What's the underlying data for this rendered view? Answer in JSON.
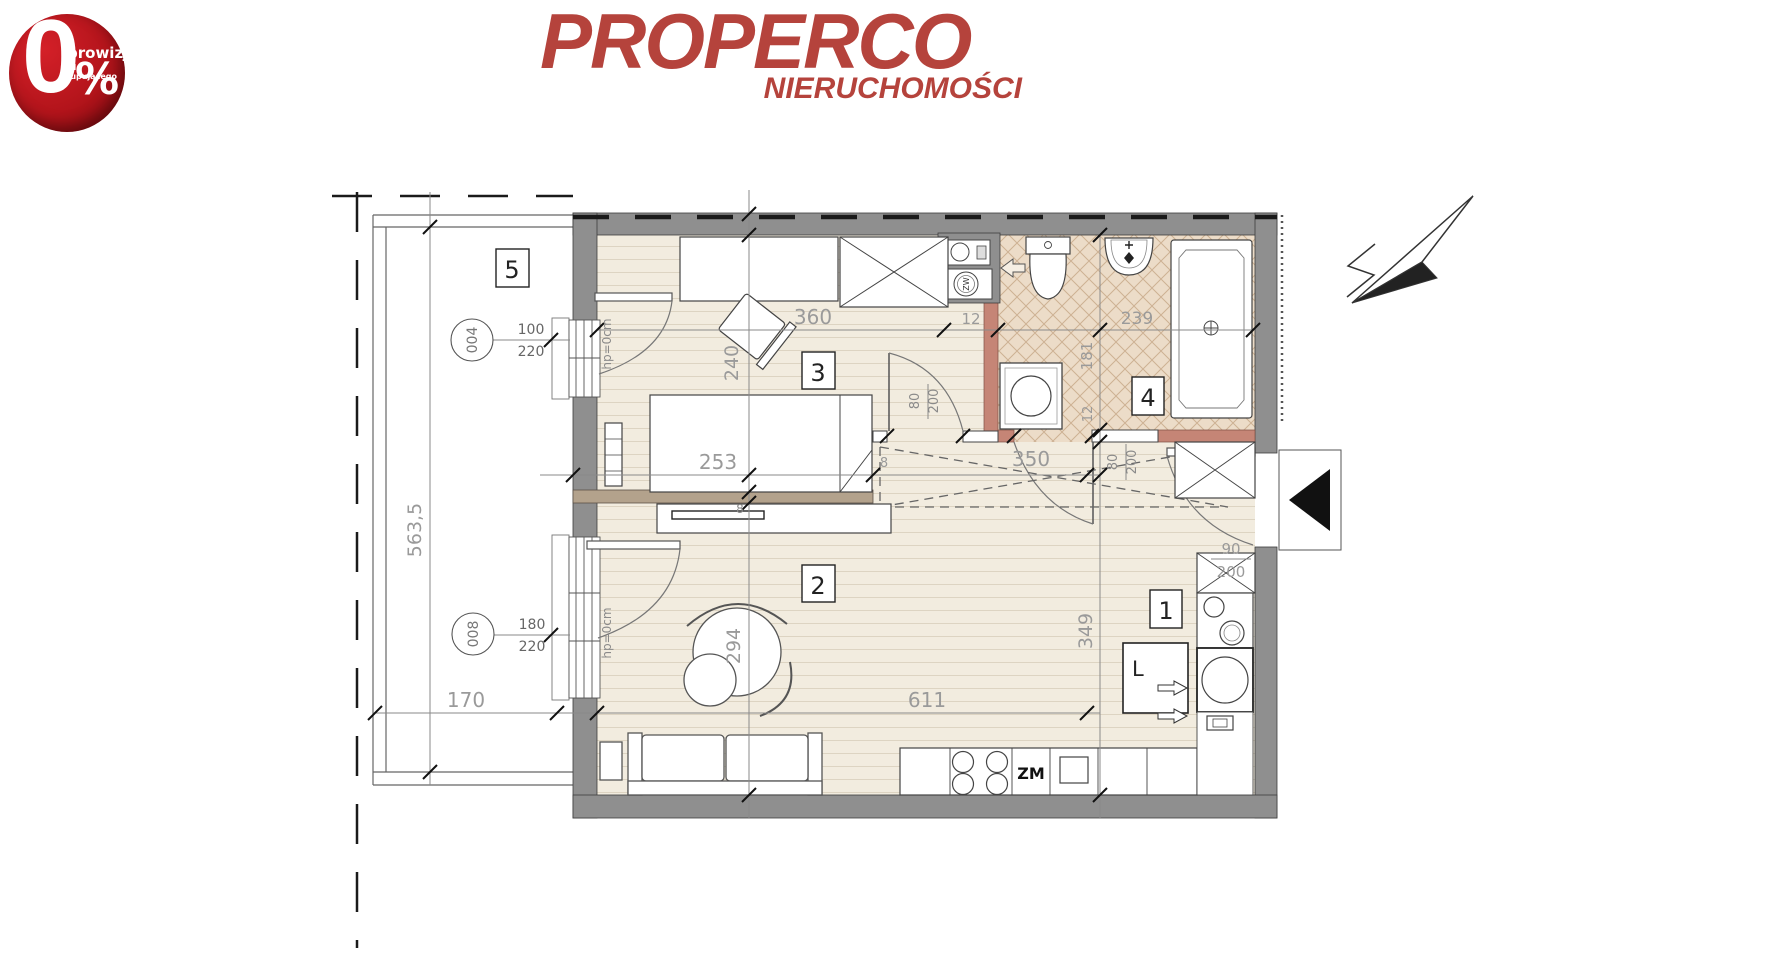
{
  "badge": {
    "zero": "0",
    "percent": "%",
    "line1": "prowizji",
    "line2": "od kupującego",
    "color": "#b3141b"
  },
  "logo": {
    "name": "PROPERCO",
    "tagline": "NIERUCHOMOŚCI",
    "color": "#b5433c"
  },
  "plan": {
    "colors": {
      "wall_gray": "#8f8f8f",
      "partition_pink": "#c58576",
      "partial_wall_tan": "#b3a28c",
      "floor_beige": "#f2ecdf",
      "tile_beige": "#ecdcc8"
    },
    "rooms": {
      "r1": "1",
      "r2": "2",
      "r3": "3",
      "r4": "4",
      "r5": "5"
    },
    "dims": {
      "bedroom_width": "360",
      "shaft_width": "12",
      "bath_width": "239",
      "bedroom_height": "240",
      "bath_height": "181",
      "bath_wall": "12",
      "bed_length": "253",
      "door_gap": "8",
      "wall_thk": "8",
      "storage_width": "350",
      "hall_height": "349",
      "living_height": "294",
      "living_width": "611",
      "balcony_width": "170",
      "balcony_length": "563,5"
    },
    "openings": {
      "w1a": "100",
      "w1b": "220",
      "w2a": "180",
      "w2b": "220",
      "db1a": "80",
      "db1b": "200",
      "db2a": "80",
      "db2b": "200",
      "dea": "90",
      "deb": "200",
      "hp1": "hp=0cm",
      "hp2": "hp=0cm"
    },
    "refs": {
      "r004": "004",
      "r008": "008"
    },
    "labels": {
      "fridge": "L",
      "sink": "ZM",
      "meter": "ZW"
    }
  }
}
